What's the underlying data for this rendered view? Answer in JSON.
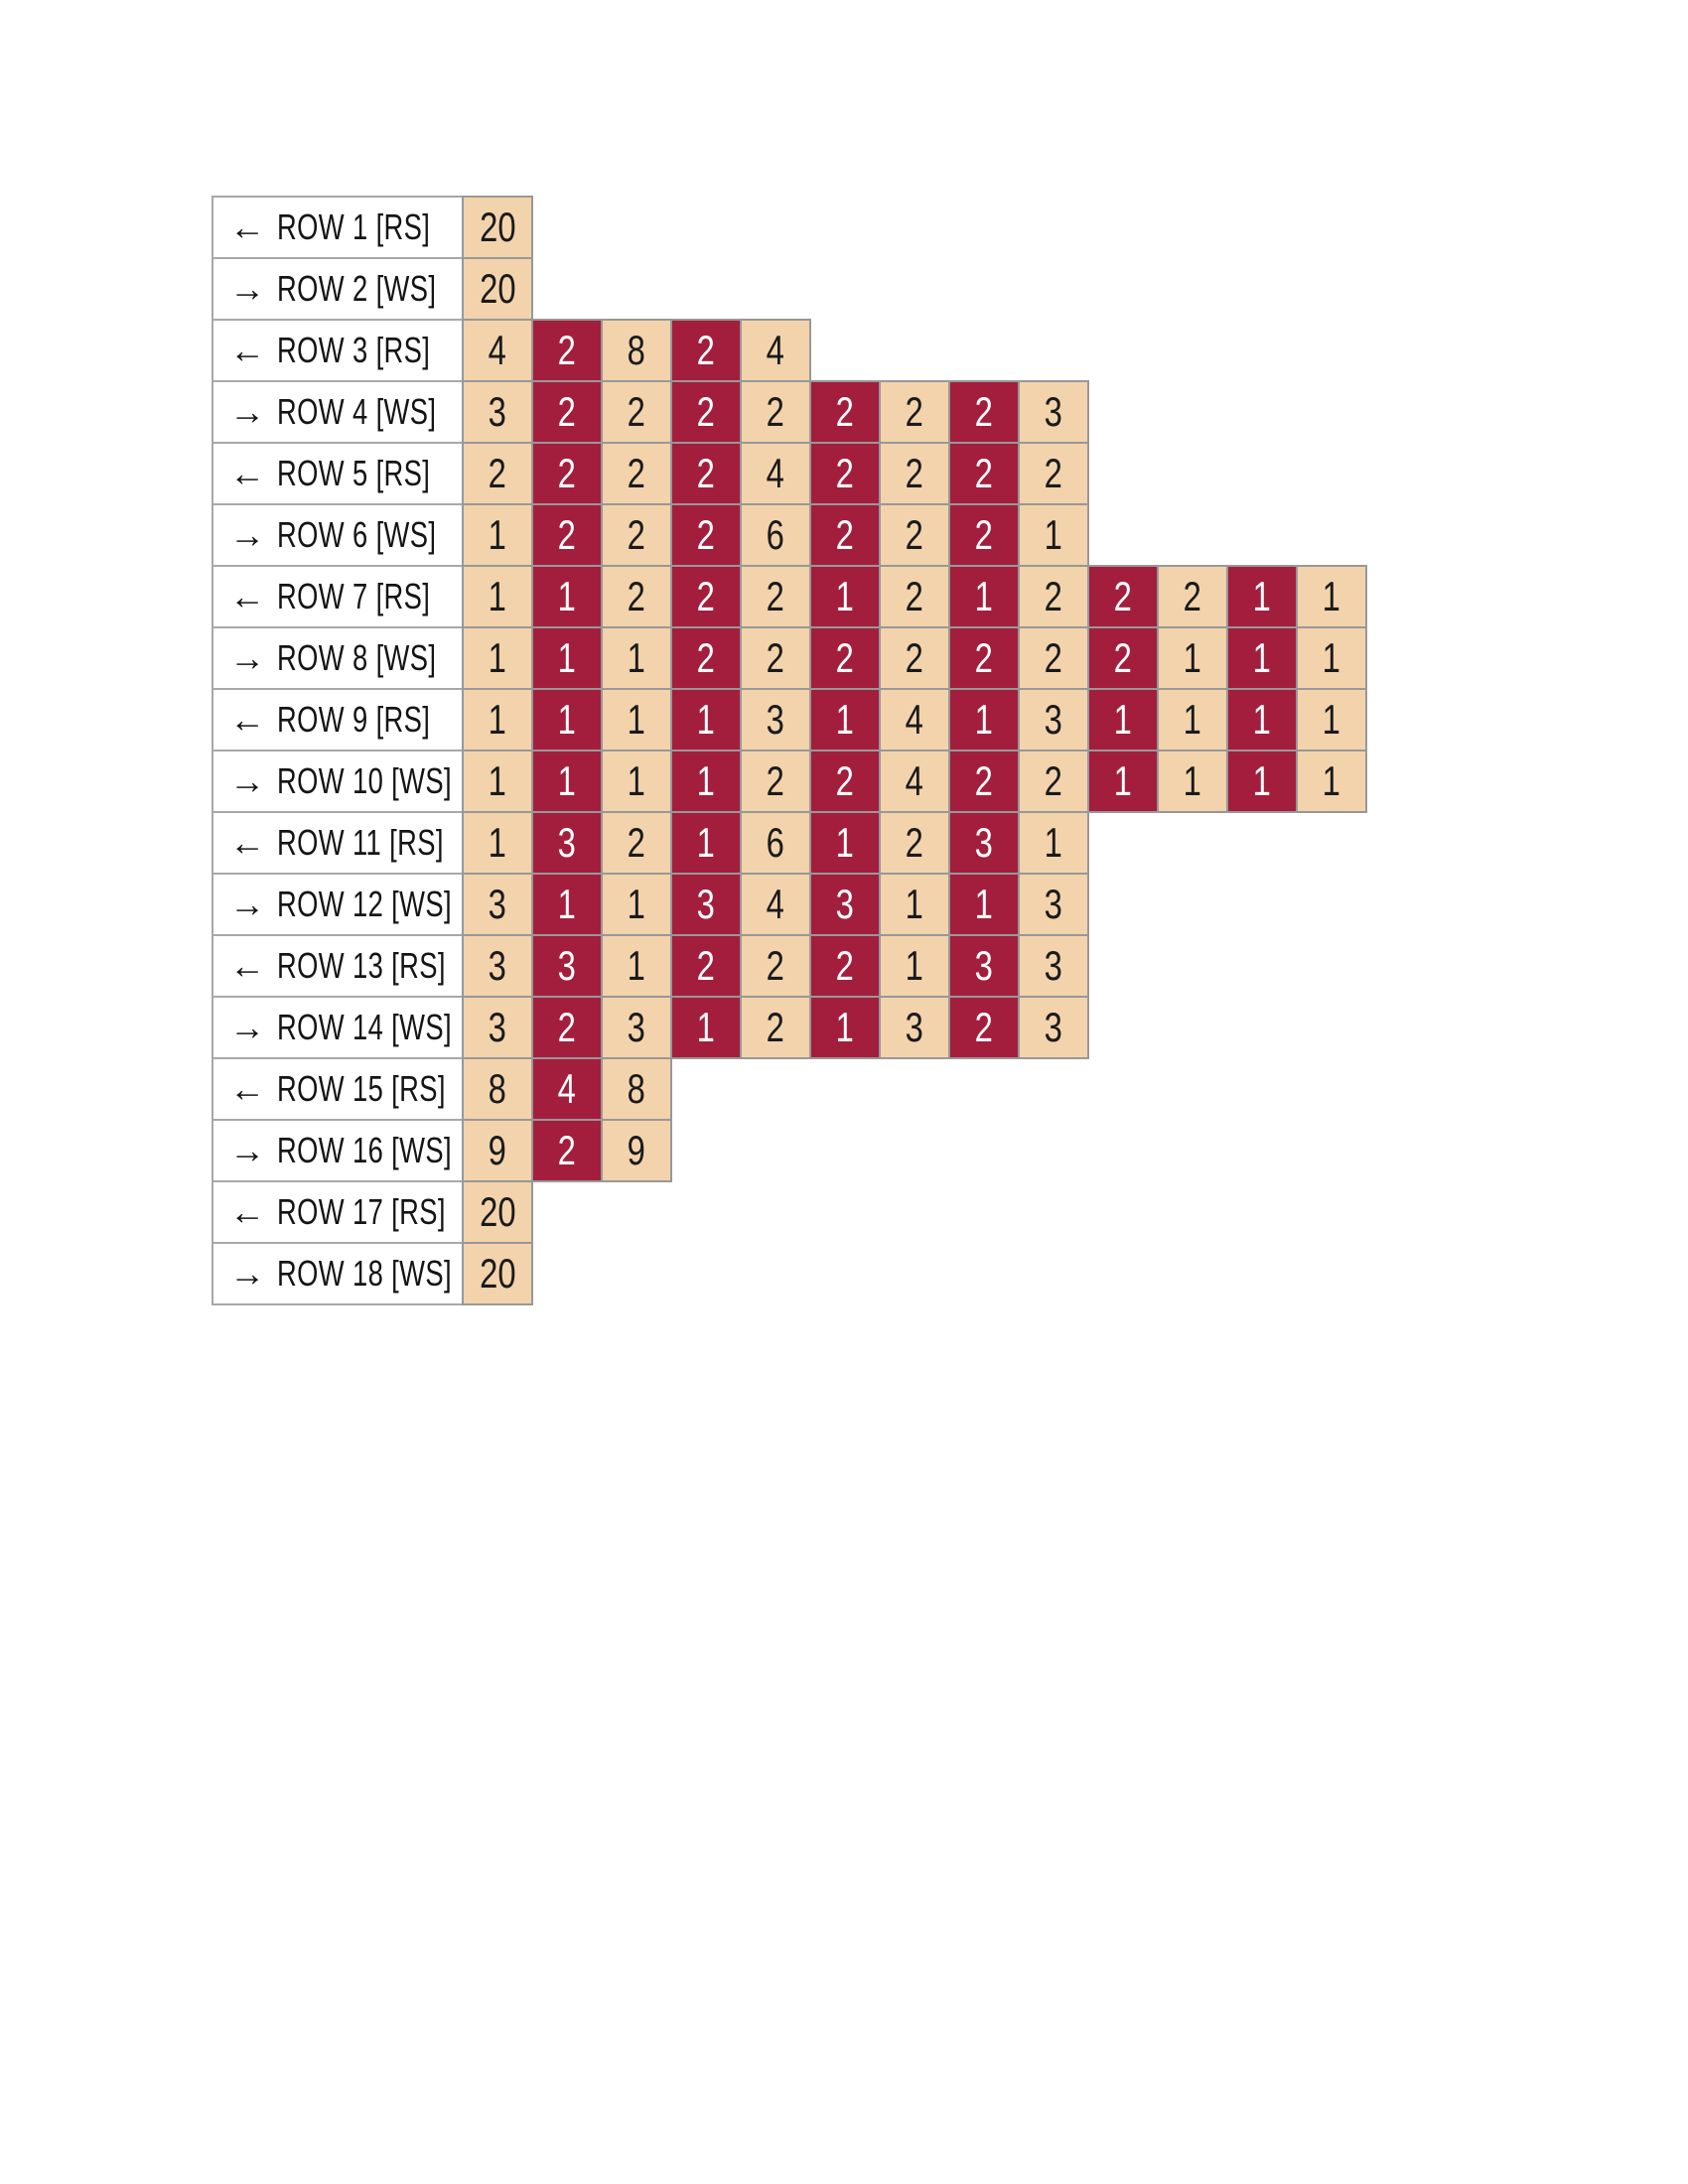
{
  "colors": {
    "color_a_fill": "#F2D3AB",
    "color_a_text": "#1a1a1a",
    "color_b_fill": "#A31E3D",
    "color_b_text": "#ffffff",
    "cell_border": "#989898",
    "label_border": "#a8a8a8",
    "label_bg": "#ffffff",
    "page_bg": "#ffffff"
  },
  "chart_data": {
    "type": "table",
    "description_visible_title": "",
    "max_columns": 13,
    "stitches_per_row": 20,
    "color_keys": {
      "A": "tan",
      "B": "dark-red"
    },
    "rows": [
      {
        "arrow": "←",
        "label": "ROW 1 [RS]",
        "cells": [
          {
            "count": 20,
            "color": "A"
          }
        ]
      },
      {
        "arrow": "→",
        "label": "ROW 2 [WS]",
        "cells": [
          {
            "count": 20,
            "color": "A"
          }
        ]
      },
      {
        "arrow": "←",
        "label": "ROW 3 [RS]",
        "cells": [
          {
            "count": 4,
            "color": "A"
          },
          {
            "count": 2,
            "color": "B"
          },
          {
            "count": 8,
            "color": "A"
          },
          {
            "count": 2,
            "color": "B"
          },
          {
            "count": 4,
            "color": "A"
          }
        ]
      },
      {
        "arrow": "→",
        "label": "ROW 4 [WS]",
        "cells": [
          {
            "count": 3,
            "color": "A"
          },
          {
            "count": 2,
            "color": "B"
          },
          {
            "count": 2,
            "color": "A"
          },
          {
            "count": 2,
            "color": "B"
          },
          {
            "count": 2,
            "color": "A"
          },
          {
            "count": 2,
            "color": "B"
          },
          {
            "count": 2,
            "color": "A"
          },
          {
            "count": 2,
            "color": "B"
          },
          {
            "count": 3,
            "color": "A"
          }
        ]
      },
      {
        "arrow": "←",
        "label": "ROW 5 [RS]",
        "cells": [
          {
            "count": 2,
            "color": "A"
          },
          {
            "count": 2,
            "color": "B"
          },
          {
            "count": 2,
            "color": "A"
          },
          {
            "count": 2,
            "color": "B"
          },
          {
            "count": 4,
            "color": "A"
          },
          {
            "count": 2,
            "color": "B"
          },
          {
            "count": 2,
            "color": "A"
          },
          {
            "count": 2,
            "color": "B"
          },
          {
            "count": 2,
            "color": "A"
          }
        ]
      },
      {
        "arrow": "→",
        "label": "ROW 6 [WS]",
        "cells": [
          {
            "count": 1,
            "color": "A"
          },
          {
            "count": 2,
            "color": "B"
          },
          {
            "count": 2,
            "color": "A"
          },
          {
            "count": 2,
            "color": "B"
          },
          {
            "count": 6,
            "color": "A"
          },
          {
            "count": 2,
            "color": "B"
          },
          {
            "count": 2,
            "color": "A"
          },
          {
            "count": 2,
            "color": "B"
          },
          {
            "count": 1,
            "color": "A"
          }
        ]
      },
      {
        "arrow": "←",
        "label": "ROW 7 [RS]",
        "cells": [
          {
            "count": 1,
            "color": "A"
          },
          {
            "count": 1,
            "color": "B"
          },
          {
            "count": 2,
            "color": "A"
          },
          {
            "count": 2,
            "color": "B"
          },
          {
            "count": 2,
            "color": "A"
          },
          {
            "count": 1,
            "color": "B"
          },
          {
            "count": 2,
            "color": "A"
          },
          {
            "count": 1,
            "color": "B"
          },
          {
            "count": 2,
            "color": "A"
          },
          {
            "count": 2,
            "color": "B"
          },
          {
            "count": 2,
            "color": "A"
          },
          {
            "count": 1,
            "color": "B"
          },
          {
            "count": 1,
            "color": "A"
          }
        ]
      },
      {
        "arrow": "→",
        "label": "ROW 8 [WS]",
        "cells": [
          {
            "count": 1,
            "color": "A"
          },
          {
            "count": 1,
            "color": "B"
          },
          {
            "count": 1,
            "color": "A"
          },
          {
            "count": 2,
            "color": "B"
          },
          {
            "count": 2,
            "color": "A"
          },
          {
            "count": 2,
            "color": "B"
          },
          {
            "count": 2,
            "color": "A"
          },
          {
            "count": 2,
            "color": "B"
          },
          {
            "count": 2,
            "color": "A"
          },
          {
            "count": 2,
            "color": "B"
          },
          {
            "count": 1,
            "color": "A"
          },
          {
            "count": 1,
            "color": "B"
          },
          {
            "count": 1,
            "color": "A"
          }
        ]
      },
      {
        "arrow": "←",
        "label": "ROW 9 [RS]",
        "cells": [
          {
            "count": 1,
            "color": "A"
          },
          {
            "count": 1,
            "color": "B"
          },
          {
            "count": 1,
            "color": "A"
          },
          {
            "count": 1,
            "color": "B"
          },
          {
            "count": 3,
            "color": "A"
          },
          {
            "count": 1,
            "color": "B"
          },
          {
            "count": 4,
            "color": "A"
          },
          {
            "count": 1,
            "color": "B"
          },
          {
            "count": 3,
            "color": "A"
          },
          {
            "count": 1,
            "color": "B"
          },
          {
            "count": 1,
            "color": "A"
          },
          {
            "count": 1,
            "color": "B"
          },
          {
            "count": 1,
            "color": "A"
          }
        ]
      },
      {
        "arrow": "→",
        "label": "ROW 10 [WS]",
        "cells": [
          {
            "count": 1,
            "color": "A"
          },
          {
            "count": 1,
            "color": "B"
          },
          {
            "count": 1,
            "color": "A"
          },
          {
            "count": 1,
            "color": "B"
          },
          {
            "count": 2,
            "color": "A"
          },
          {
            "count": 2,
            "color": "B"
          },
          {
            "count": 4,
            "color": "A"
          },
          {
            "count": 2,
            "color": "B"
          },
          {
            "count": 2,
            "color": "A"
          },
          {
            "count": 1,
            "color": "B"
          },
          {
            "count": 1,
            "color": "A"
          },
          {
            "count": 1,
            "color": "B"
          },
          {
            "count": 1,
            "color": "A"
          }
        ]
      },
      {
        "arrow": "←",
        "label": "ROW 11 [RS]",
        "cells": [
          {
            "count": 1,
            "color": "A"
          },
          {
            "count": 3,
            "color": "B"
          },
          {
            "count": 2,
            "color": "A"
          },
          {
            "count": 1,
            "color": "B"
          },
          {
            "count": 6,
            "color": "A"
          },
          {
            "count": 1,
            "color": "B"
          },
          {
            "count": 2,
            "color": "A"
          },
          {
            "count": 3,
            "color": "B"
          },
          {
            "count": 1,
            "color": "A"
          }
        ]
      },
      {
        "arrow": "→",
        "label": "ROW 12 [WS]",
        "cells": [
          {
            "count": 3,
            "color": "A"
          },
          {
            "count": 1,
            "color": "B"
          },
          {
            "count": 1,
            "color": "A"
          },
          {
            "count": 3,
            "color": "B"
          },
          {
            "count": 4,
            "color": "A"
          },
          {
            "count": 3,
            "color": "B"
          },
          {
            "count": 1,
            "color": "A"
          },
          {
            "count": 1,
            "color": "B"
          },
          {
            "count": 3,
            "color": "A"
          }
        ]
      },
      {
        "arrow": "←",
        "label": "ROW 13 [RS]",
        "cells": [
          {
            "count": 3,
            "color": "A"
          },
          {
            "count": 3,
            "color": "B"
          },
          {
            "count": 1,
            "color": "A"
          },
          {
            "count": 2,
            "color": "B"
          },
          {
            "count": 2,
            "color": "A"
          },
          {
            "count": 2,
            "color": "B"
          },
          {
            "count": 1,
            "color": "A"
          },
          {
            "count": 3,
            "color": "B"
          },
          {
            "count": 3,
            "color": "A"
          }
        ]
      },
      {
        "arrow": "→",
        "label": "ROW 14 [WS]",
        "cells": [
          {
            "count": 3,
            "color": "A"
          },
          {
            "count": 2,
            "color": "B"
          },
          {
            "count": 3,
            "color": "A"
          },
          {
            "count": 1,
            "color": "B"
          },
          {
            "count": 2,
            "color": "A"
          },
          {
            "count": 1,
            "color": "B"
          },
          {
            "count": 3,
            "color": "A"
          },
          {
            "count": 2,
            "color": "B"
          },
          {
            "count": 3,
            "color": "A"
          }
        ]
      },
      {
        "arrow": "←",
        "label": "ROW 15 [RS]",
        "cells": [
          {
            "count": 8,
            "color": "A"
          },
          {
            "count": 4,
            "color": "B"
          },
          {
            "count": 8,
            "color": "A"
          }
        ]
      },
      {
        "arrow": "→",
        "label": "ROW 16 [WS]",
        "cells": [
          {
            "count": 9,
            "color": "A"
          },
          {
            "count": 2,
            "color": "B"
          },
          {
            "count": 9,
            "color": "A"
          }
        ]
      },
      {
        "arrow": "←",
        "label": "ROW 17 [RS]",
        "cells": [
          {
            "count": 20,
            "color": "A"
          }
        ]
      },
      {
        "arrow": "→",
        "label": "ROW 18 [WS]",
        "cells": [
          {
            "count": 20,
            "color": "A"
          }
        ]
      }
    ]
  }
}
